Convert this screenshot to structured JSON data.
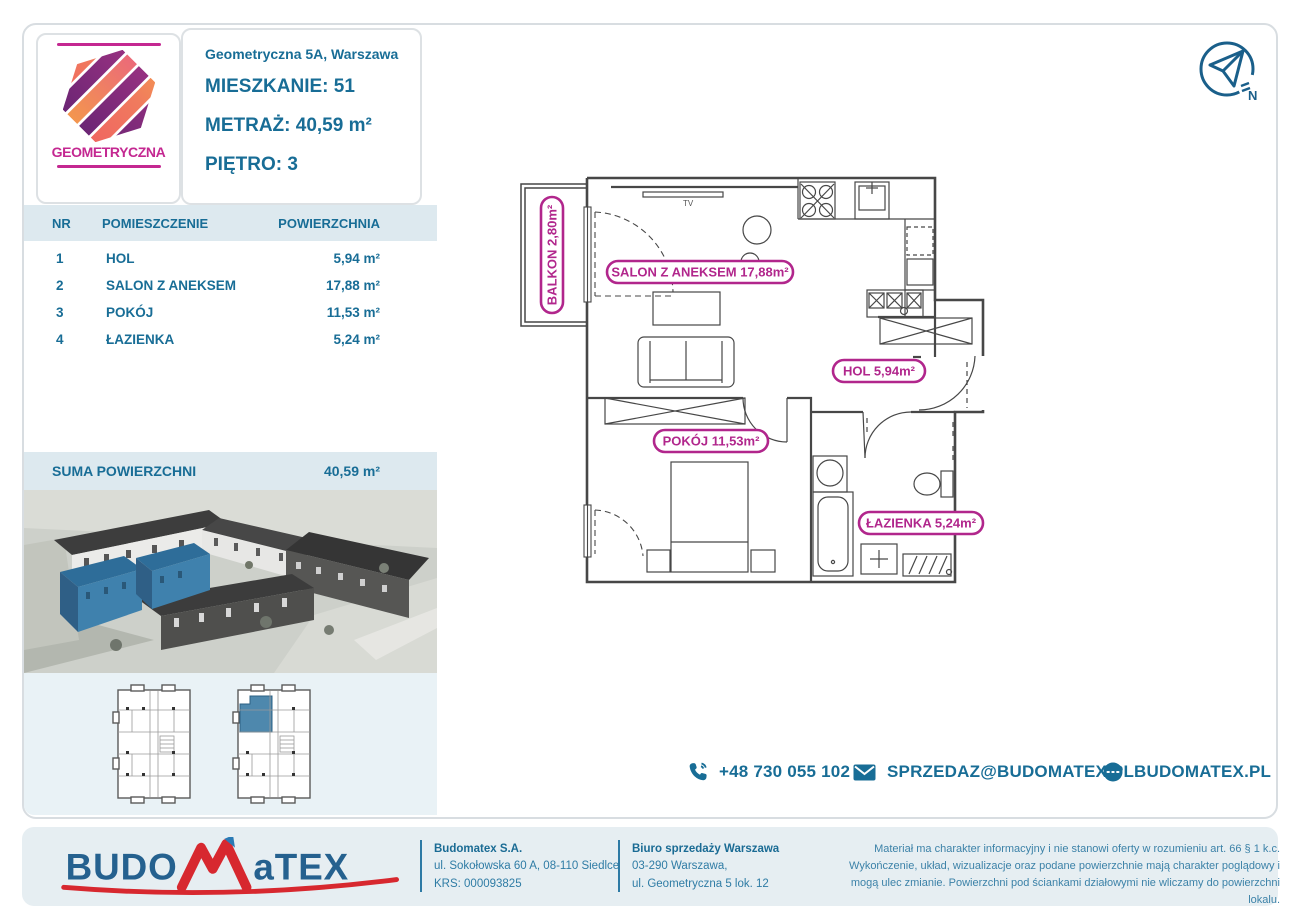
{
  "brand": {
    "name": "GEOMETRYCZNA"
  },
  "header": {
    "address": "Geometryczna 5A, Warszawa",
    "apartment_label": "MIESZKANIE:",
    "apartment_value": "51",
    "area_label": "METRAŻ:",
    "area_value": "40,59 m²",
    "floor_label": "PIĘTRO:",
    "floor_value": "3"
  },
  "rooms_table": {
    "headers": [
      "NR",
      "POMIESZCZENIE",
      "POWIERZCHNIA"
    ],
    "rows": [
      {
        "no": "1",
        "name": "HOL",
        "area": "5,94 m²"
      },
      {
        "no": "2",
        "name": "SALON Z ANEKSEM",
        "area": "17,88 m²"
      },
      {
        "no": "3",
        "name": "POKÓJ",
        "area": "11,53 m²"
      },
      {
        "no": "4",
        "name": "ŁAZIENKA",
        "area": "5,24 m²"
      }
    ],
    "summary_label": "SUMA POWIERZCHNI",
    "summary_value": "40,59 m²"
  },
  "floor_plan": {
    "labels": {
      "balkon": "BALKON 2,80m²",
      "salon": "SALON Z ANEKSEM 17,88m²",
      "hol": "HOL 5,94m²",
      "pokoj": "POKÓJ 11,53m²",
      "lazienka": "ŁAZIENKA 5,24m²",
      "tv": "TV"
    },
    "compass_north": "N"
  },
  "contact": {
    "phone": "+48 730 055 102",
    "email": "SPRZEDAZ@BUDOMATEX.PL",
    "website": "BUDOMATEX.PL"
  },
  "footer": {
    "logo_part1": "BUDO",
    "logo_part2": "M",
    "logo_part3": "aTEX",
    "company": [
      "Budomatex S.A.",
      "ul. Sokołowska 60 A, 08-110 Siedlce",
      "KRS: 000093825"
    ],
    "office": [
      "Biuro sprzedaży Warszawa",
      "03-290 Warszawa,",
      "ul. Geometryczna 5 lok. 12"
    ],
    "disclaimer": "Materiał ma charakter informacyjny i nie stanowi oferty w rozumieniu art. 66 § 1 k.c. Wykończenie, układ, wizualizacje oraz podane powierzchnie mają charakter poglądowy i mogą ulec zmianie. Powierzchni pod ściankami działowymi nie wliczamy do powierzchni lokalu."
  },
  "colors": {
    "teal_text": "#186d96",
    "magenta_accent": "#b1268c",
    "band_blue": "#dde9ef",
    "panel_blue": "#e9f2f6",
    "footer_band": "#e6eef2",
    "logo_red": "#d7282f",
    "logo_blue": "#25618f",
    "highlight_building_blue": "#3f81ad"
  }
}
